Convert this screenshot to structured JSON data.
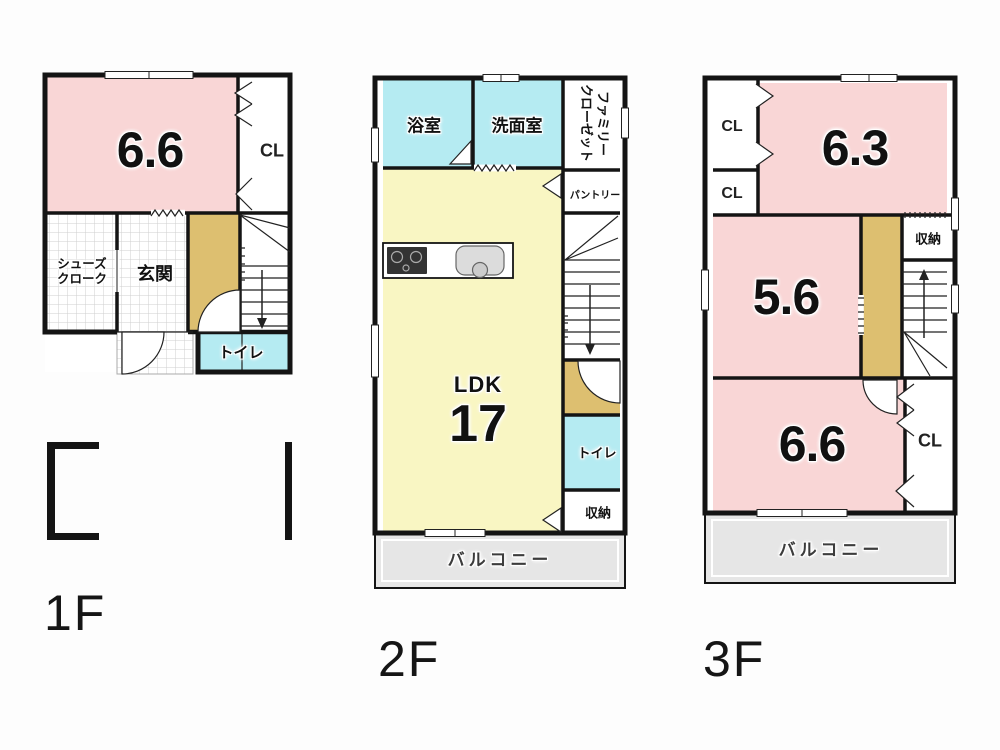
{
  "colors": {
    "room-pink": "#f9d6d6",
    "room-cyan": "#b5ebf2",
    "room-yellow": "#f9f6c3",
    "hall-tan": "#ddbf70",
    "balcony-gray": "#e6e6e6",
    "wall": "#141414",
    "text": "#111111"
  },
  "floor1": {
    "label": "1F",
    "bedroom_size": "6.6",
    "closet": "CL",
    "shoes_closet_line1": "シューズ",
    "shoes_closet_line2": "クローク",
    "entrance": "玄関",
    "toilet": "トイレ"
  },
  "floor2": {
    "label": "2F",
    "bathroom": "浴室",
    "washroom": "洗面室",
    "family_closet_line1": "ファミリー",
    "family_closet_line2": "クローゼット",
    "pantry": "パントリー",
    "ldk": "LDK",
    "ldk_size": "17",
    "toilet": "トイレ",
    "storage": "収納",
    "balcony": "バルコニー"
  },
  "floor3": {
    "label": "3F",
    "closet_top": "CL",
    "room_63_size": "6.3",
    "closet_mid": "CL",
    "room_56_size": "5.6",
    "storage": "収納",
    "room_66_size": "6.6",
    "closet_right": "CL",
    "balcony": "バルコニー"
  }
}
